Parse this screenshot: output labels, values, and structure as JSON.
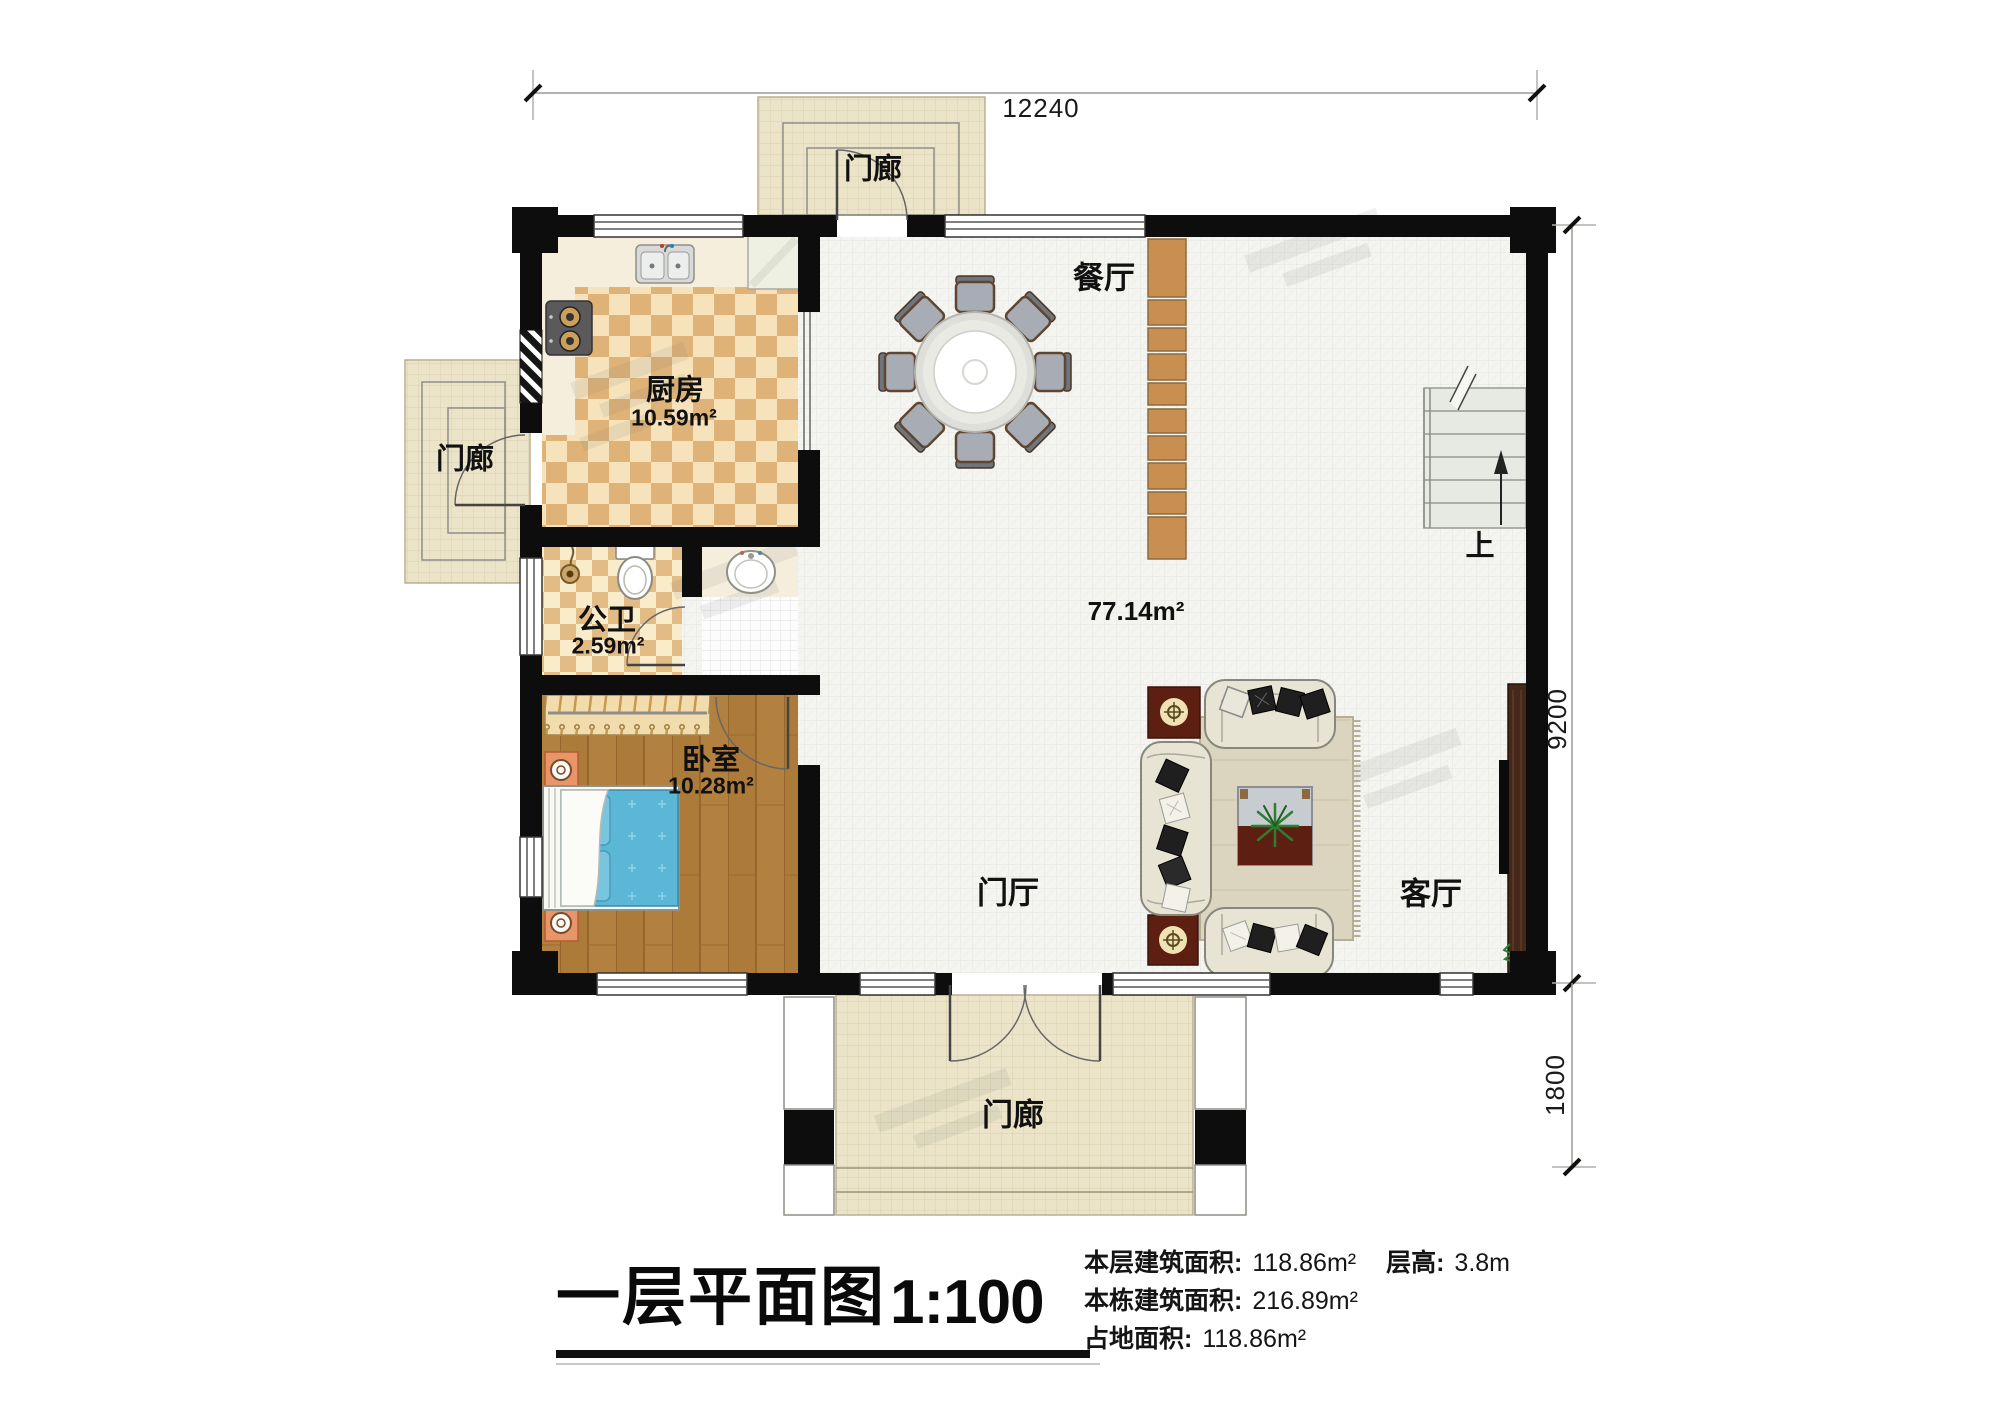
{
  "dimensions": {
    "width_total": "12240",
    "height_main": "9200",
    "height_porch": "1800"
  },
  "rooms": {
    "porch_top": {
      "name": "门廊"
    },
    "porch_left": {
      "name": "门廊"
    },
    "porch_bottom": {
      "name": "门廊"
    },
    "dining": {
      "name": "餐厅"
    },
    "kitchen": {
      "name": "厨房",
      "area": "10.59m²"
    },
    "bathroom": {
      "name": "公卫",
      "area": "2.59m²"
    },
    "bedroom": {
      "name": "卧室",
      "area": "10.28m²"
    },
    "hall": {
      "name": "门厅"
    },
    "living": {
      "name": "客厅"
    },
    "open_area": {
      "area": "77.14m²"
    },
    "stairs": {
      "up_label": "上"
    }
  },
  "footer": {
    "title": "一层平面图",
    "scale": "1:100",
    "stats_rows": [
      {
        "label": "本层建筑面积:",
        "value": "118.86m²",
        "extra_label": "层高:",
        "extra_value": "3.8m"
      },
      {
        "label": "本栋建筑面积:",
        "value": "216.89m²"
      },
      {
        "label": "占地面积:",
        "value": "118.86m²"
      }
    ]
  }
}
